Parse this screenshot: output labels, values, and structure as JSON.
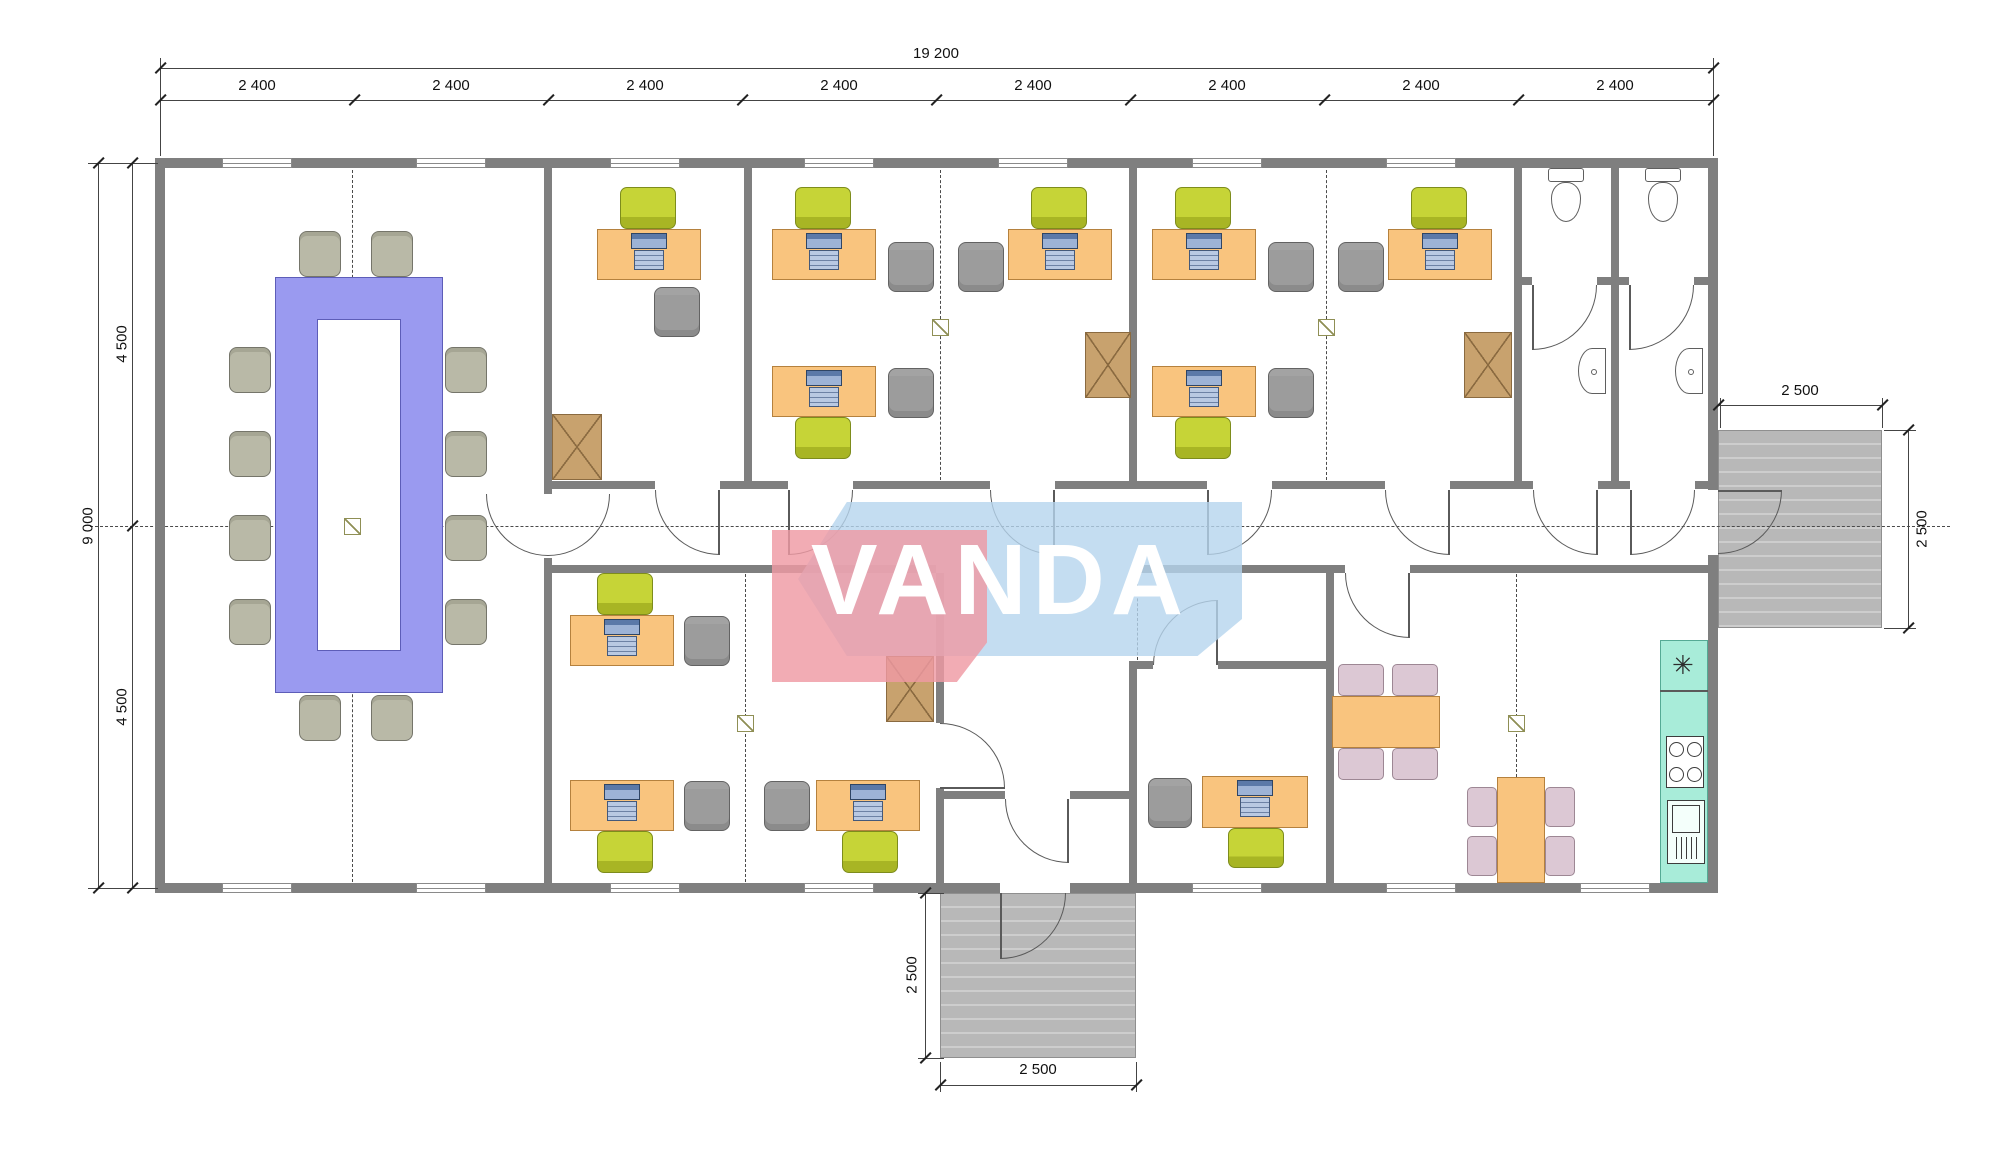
{
  "watermark": {
    "text": "VANDA",
    "pink": "#ef9aa4",
    "blue": "#b5d4ee"
  },
  "colors": {
    "wall": "#7f7f7f",
    "desk": "#f9c47e",
    "task_chair": "#c6d437",
    "guest_chair": "#9c9c9c",
    "conference_table": "#9a9af0",
    "conference_chair": "#b9b9a7",
    "cabinet": "#c8a26e",
    "dining_chair": "#dcc8d4",
    "kitchen_counter": "#a8ecd9",
    "porch": "#b8b8b8"
  },
  "dim_labels": [
    {
      "text": "19 200",
      "x": 936,
      "y": 62,
      "rot": false,
      "name": "dim-total-width"
    },
    {
      "text": "2 400",
      "x": 257,
      "y": 94,
      "rot": false,
      "name": "dim-bay-1"
    },
    {
      "text": "2 400",
      "x": 451,
      "y": 94,
      "rot": false,
      "name": "dim-bay-2"
    },
    {
      "text": "2 400",
      "x": 645,
      "y": 94,
      "rot": false,
      "name": "dim-bay-3"
    },
    {
      "text": "2 400",
      "x": 839,
      "y": 94,
      "rot": false,
      "name": "dim-bay-4"
    },
    {
      "text": "2 400",
      "x": 1033,
      "y": 94,
      "rot": false,
      "name": "dim-bay-5"
    },
    {
      "text": "2 400",
      "x": 1227,
      "y": 94,
      "rot": false,
      "name": "dim-bay-6"
    },
    {
      "text": "2 400",
      "x": 1421,
      "y": 94,
      "rot": false,
      "name": "dim-bay-7"
    },
    {
      "text": "2 400",
      "x": 1615,
      "y": 94,
      "rot": false,
      "name": "dim-bay-8"
    },
    {
      "text": "9 000",
      "x": 88,
      "y": 526,
      "rot": true,
      "name": "dim-total-depth"
    },
    {
      "text": "4 500",
      "x": 122,
      "y": 344,
      "rot": true,
      "name": "dim-depth-upper"
    },
    {
      "text": "4 500",
      "x": 122,
      "y": 707,
      "rot": true,
      "name": "dim-depth-lower"
    },
    {
      "text": "2 500",
      "x": 1800,
      "y": 399,
      "rot": false,
      "name": "dim-right-porch-width"
    },
    {
      "text": "2 500",
      "x": 1922,
      "y": 529,
      "rot": true,
      "name": "dim-right-porch-depth"
    },
    {
      "text": "2 500",
      "x": 912,
      "y": 975,
      "rot": true,
      "name": "dim-bottom-porch-depth"
    },
    {
      "text": "2 500",
      "x": 1038,
      "y": 1078,
      "rot": false,
      "name": "dim-bottom-porch-width"
    }
  ],
  "dimlines": [
    {
      "x": 160,
      "y": 68,
      "w": 1553,
      "h": 1
    },
    {
      "x": 160,
      "y": 100,
      "w": 1553,
      "h": 1
    },
    {
      "x": 98,
      "y": 163,
      "w": 1,
      "h": 725
    },
    {
      "x": 132,
      "y": 163,
      "w": 1,
      "h": 725
    },
    {
      "x": 1718,
      "y": 405,
      "w": 164,
      "h": 1
    },
    {
      "x": 1908,
      "y": 430,
      "w": 1,
      "h": 198
    },
    {
      "x": 925,
      "y": 893,
      "w": 1,
      "h": 165
    },
    {
      "x": 940,
      "y": 1085,
      "w": 196,
      "h": 1
    }
  ],
  "ext_lines": [
    {
      "x": 160,
      "y": 58,
      "w": 1,
      "h": 98
    },
    {
      "x": 1713,
      "y": 58,
      "w": 1,
      "h": 98
    },
    {
      "x": 88,
      "y": 163,
      "w": 70,
      "h": 1
    },
    {
      "x": 88,
      "y": 888,
      "w": 70,
      "h": 1
    },
    {
      "x": 1720,
      "y": 398,
      "w": 1,
      "h": 30
    },
    {
      "x": 1882,
      "y": 398,
      "w": 1,
      "h": 30
    },
    {
      "x": 1884,
      "y": 430,
      "w": 32,
      "h": 1
    },
    {
      "x": 1884,
      "y": 628,
      "w": 32,
      "h": 1
    },
    {
      "x": 918,
      "y": 893,
      "w": 26,
      "h": 1
    },
    {
      "x": 918,
      "y": 1058,
      "w": 26,
      "h": 1
    },
    {
      "x": 940,
      "y": 1062,
      "w": 1,
      "h": 30
    },
    {
      "x": 1136,
      "y": 1062,
      "w": 1,
      "h": 30
    }
  ],
  "ticks": [
    {
      "x": 160,
      "y": 68
    },
    {
      "x": 1713,
      "y": 68
    },
    {
      "x": 160,
      "y": 100
    },
    {
      "x": 354,
      "y": 100
    },
    {
      "x": 548,
      "y": 100
    },
    {
      "x": 742,
      "y": 100
    },
    {
      "x": 936,
      "y": 100
    },
    {
      "x": 1130,
      "y": 100
    },
    {
      "x": 1324,
      "y": 100
    },
    {
      "x": 1518,
      "y": 100
    },
    {
      "x": 1713,
      "y": 100
    },
    {
      "x": 98,
      "y": 163
    },
    {
      "x": 98,
      "y": 888
    },
    {
      "x": 132,
      "y": 163
    },
    {
      "x": 132,
      "y": 526
    },
    {
      "x": 132,
      "y": 888
    },
    {
      "x": 1718,
      "y": 405
    },
    {
      "x": 1882,
      "y": 405
    },
    {
      "x": 1908,
      "y": 430
    },
    {
      "x": 1908,
      "y": 628
    },
    {
      "x": 925,
      "y": 893
    },
    {
      "x": 925,
      "y": 1058
    },
    {
      "x": 940,
      "y": 1085
    },
    {
      "x": 1136,
      "y": 1085
    }
  ],
  "porches": [
    {
      "x": 1718,
      "y": 430,
      "w": 164,
      "h": 198,
      "name": "right-porch-deck"
    },
    {
      "x": 940,
      "y": 893,
      "w": 196,
      "h": 165,
      "name": "bottom-porch-deck"
    }
  ],
  "walls": [
    [
      155,
      158,
      1563,
      10
    ],
    [
      155,
      883,
      845,
      10
    ],
    [
      1070,
      883,
      648,
      10
    ],
    [
      155,
      158,
      10,
      735
    ],
    [
      1708,
      158,
      10,
      332
    ],
    [
      1708,
      555,
      10,
      338
    ],
    [
      544,
      168,
      8,
      326
    ],
    [
      544,
      558,
      8,
      325
    ],
    [
      744,
      168,
      8,
      313
    ],
    [
      1129,
      168,
      8,
      313
    ],
    [
      1514,
      168,
      8,
      313
    ],
    [
      1611,
      168,
      8,
      313
    ],
    [
      936,
      573,
      8,
      150
    ],
    [
      936,
      788,
      8,
      95
    ],
    [
      1129,
      661,
      8,
      222
    ],
    [
      1326,
      573,
      8,
      310
    ],
    [
      552,
      481,
      103,
      8
    ],
    [
      720,
      481,
      68,
      8
    ],
    [
      853,
      481,
      137,
      8
    ],
    [
      1055,
      481,
      152,
      8
    ],
    [
      1272,
      481,
      113,
      8
    ],
    [
      1450,
      481,
      83,
      8
    ],
    [
      1598,
      481,
      32,
      8
    ],
    [
      1695,
      481,
      13,
      8
    ],
    [
      552,
      565,
      384,
      8
    ],
    [
      1133,
      565,
      212,
      8
    ],
    [
      1410,
      565,
      298,
      8
    ],
    [
      1522,
      277,
      10,
      8
    ],
    [
      1597,
      277,
      14,
      8
    ],
    [
      1619,
      277,
      10,
      8
    ],
    [
      1694,
      277,
      14,
      8
    ],
    [
      940,
      791,
      65,
      8
    ],
    [
      1070,
      791,
      63,
      8
    ],
    [
      1133,
      661,
      20,
      8
    ],
    [
      1218,
      661,
      108,
      8
    ]
  ],
  "windows": [
    [
      222,
      158,
      70
    ],
    [
      416,
      158,
      70
    ],
    [
      610,
      158,
      70
    ],
    [
      804,
      158,
      70
    ],
    [
      998,
      158,
      70
    ],
    [
      1192,
      158,
      70
    ],
    [
      1386,
      158,
      70
    ],
    [
      222,
      883,
      70
    ],
    [
      416,
      883,
      70
    ],
    [
      610,
      883,
      70
    ],
    [
      804,
      883,
      70
    ],
    [
      1192,
      883,
      70
    ],
    [
      1386,
      883,
      70
    ],
    [
      1580,
      883,
      70
    ]
  ],
  "doors": [
    {
      "x": 548,
      "y": 494,
      "r": 62,
      "quad": "br"
    },
    {
      "x": 486,
      "y": 494,
      "r": 62,
      "quad": "bl"
    },
    {
      "x": 655,
      "y": 490,
      "r": 65,
      "quad": "bl",
      "leaf": [
        718,
        490,
        1.5,
        65
      ]
    },
    {
      "x": 788,
      "y": 490,
      "r": 65,
      "quad": "br",
      "leaf": [
        788,
        490,
        1.5,
        65
      ]
    },
    {
      "x": 990,
      "y": 490,
      "r": 65,
      "quad": "bl",
      "leaf": [
        1053,
        490,
        1.5,
        65
      ]
    },
    {
      "x": 1207,
      "y": 490,
      "r": 65,
      "quad": "br",
      "leaf": [
        1207,
        490,
        1.5,
        65
      ]
    },
    {
      "x": 1385,
      "y": 490,
      "r": 65,
      "quad": "bl",
      "leaf": [
        1448,
        490,
        1.5,
        65
      ]
    },
    {
      "x": 1533,
      "y": 490,
      "r": 65,
      "quad": "bl",
      "leaf": [
        1596,
        490,
        1.5,
        65
      ]
    },
    {
      "x": 1630,
      "y": 490,
      "r": 65,
      "quad": "br",
      "leaf": [
        1630,
        490,
        1.5,
        65
      ]
    },
    {
      "x": 1532,
      "y": 285,
      "r": 65,
      "quad": "br",
      "leaf": [
        1532,
        285,
        1.5,
        65
      ]
    },
    {
      "x": 1629,
      "y": 285,
      "r": 65,
      "quad": "br",
      "leaf": [
        1629,
        285,
        1.5,
        65
      ]
    },
    {
      "x": 1718,
      "y": 490,
      "r": 64,
      "quad": "br",
      "leaf": [
        1718,
        490,
        64,
        1.5
      ]
    },
    {
      "x": 940,
      "y": 723,
      "r": 65,
      "quad": "tr",
      "leaf": [
        940,
        787,
        65,
        1.5
      ]
    },
    {
      "x": 1005,
      "y": 799,
      "r": 64,
      "quad": "bl",
      "leaf": [
        1067,
        799,
        1.5,
        64
      ]
    },
    {
      "x": 1153,
      "y": 600,
      "r": 65,
      "quad": "tl",
      "leaf": [
        1216,
        600,
        1.5,
        65
      ]
    },
    {
      "x": 1345,
      "y": 573,
      "r": 65,
      "quad": "bl",
      "leaf": [
        1408,
        573,
        1.5,
        65
      ]
    },
    {
      "x": 1000,
      "y": 893,
      "r": 66,
      "quad": "br",
      "leaf": [
        1000,
        893,
        1.5,
        66
      ]
    }
  ],
  "dashes": [
    {
      "dir": "h",
      "x": 90,
      "y": 526,
      "len": 1860
    },
    {
      "dir": "v",
      "x": 352,
      "y": 170,
      "len": 712
    },
    {
      "dir": "v",
      "x": 940,
      "y": 170,
      "len": 310
    },
    {
      "dir": "v",
      "x": 1326,
      "y": 170,
      "len": 310
    },
    {
      "dir": "v",
      "x": 745,
      "y": 574,
      "len": 308
    },
    {
      "dir": "v",
      "x": 1137,
      "y": 574,
      "len": 86
    },
    {
      "dir": "v",
      "x": 1516,
      "y": 574,
      "len": 308
    }
  ],
  "markers": [
    [
      344,
      518
    ],
    [
      932,
      319
    ],
    [
      1318,
      319
    ],
    [
      737,
      715
    ],
    [
      1508,
      715
    ]
  ],
  "furniture": {
    "conference_table": {
      "outer": [
        275,
        277,
        168,
        416
      ],
      "inner": [
        317,
        319,
        84,
        332
      ]
    },
    "conference_chairs": [
      [
        299,
        231
      ],
      [
        371,
        231
      ],
      [
        299,
        695
      ],
      [
        371,
        695
      ],
      [
        229,
        347
      ],
      [
        229,
        431
      ],
      [
        229,
        515
      ],
      [
        229,
        599
      ],
      [
        445,
        347
      ],
      [
        445,
        431
      ],
      [
        445,
        515
      ],
      [
        445,
        599
      ]
    ],
    "desks": [
      [
        597,
        229,
        104,
        51
      ],
      [
        772,
        229,
        104,
        51
      ],
      [
        1008,
        229,
        104,
        51
      ],
      [
        1152,
        229,
        104,
        51
      ],
      [
        1388,
        229,
        104,
        51
      ],
      [
        772,
        366,
        104,
        51
      ],
      [
        1152,
        366,
        104,
        51
      ],
      [
        570,
        615,
        104,
        51
      ],
      [
        570,
        780,
        104,
        51
      ],
      [
        816,
        780,
        104,
        51
      ],
      [
        1202,
        776,
        106,
        52
      ]
    ],
    "green_chairs": [
      [
        620,
        187,
        56,
        42
      ],
      [
        795,
        187,
        56,
        42
      ],
      [
        1031,
        187,
        56,
        42
      ],
      [
        1175,
        187,
        56,
        42
      ],
      [
        1411,
        187,
        56,
        42
      ],
      [
        795,
        417,
        56,
        42
      ],
      [
        1175,
        417,
        56,
        42
      ],
      [
        597,
        573,
        56,
        42
      ],
      [
        597,
        831,
        56,
        42
      ],
      [
        842,
        831,
        56,
        42
      ],
      [
        1228,
        828,
        56,
        40
      ]
    ],
    "gray_chairs": [
      [
        654,
        287,
        46,
        50
      ],
      [
        888,
        242,
        46,
        50
      ],
      [
        958,
        242,
        46,
        50
      ],
      [
        1268,
        242,
        46,
        50
      ],
      [
        1338,
        242,
        46,
        50
      ],
      [
        888,
        368,
        46,
        50
      ],
      [
        1268,
        368,
        46,
        50
      ],
      [
        684,
        616,
        46,
        50
      ],
      [
        684,
        781,
        46,
        50
      ],
      [
        764,
        781,
        46,
        50
      ],
      [
        1148,
        778,
        44,
        50
      ]
    ],
    "cabinets": [
      [
        552,
        414,
        50,
        66
      ],
      [
        1085,
        332,
        46,
        66
      ],
      [
        1464,
        332,
        48,
        66
      ],
      [
        886,
        656,
        48,
        66
      ]
    ],
    "dining_tables": [
      [
        1332,
        696,
        108,
        52
      ],
      [
        1497,
        777,
        48,
        106
      ]
    ],
    "dining_chairs": [
      [
        1338,
        664,
        46,
        32
      ],
      [
        1392,
        664,
        46,
        32
      ],
      [
        1338,
        748,
        46,
        32
      ],
      [
        1392,
        748,
        46,
        32
      ],
      [
        1467,
        787,
        30,
        40
      ],
      [
        1467,
        836,
        30,
        40
      ],
      [
        1545,
        787,
        30,
        40
      ],
      [
        1545,
        836,
        30,
        40
      ]
    ],
    "toilets": [
      {
        "tank": [
          1548,
          168,
          36,
          14
        ],
        "bowl": [
          1551,
          182,
          30,
          40
        ]
      },
      {
        "tank": [
          1645,
          168,
          36,
          14
        ],
        "bowl": [
          1648,
          182,
          30,
          40
        ]
      }
    ],
    "sinks": [
      [
        1578,
        348,
        28,
        46
      ],
      [
        1675,
        348,
        28,
        46
      ]
    ],
    "kitchen": {
      "counter": [
        1660,
        640,
        48,
        243
      ],
      "divider_y": 690,
      "sink_star": {
        "x": 1672,
        "y": 652,
        "char": "✳"
      },
      "stove": [
        1666,
        736,
        38,
        52
      ],
      "appliance": [
        1667,
        800,
        38,
        64
      ]
    }
  }
}
